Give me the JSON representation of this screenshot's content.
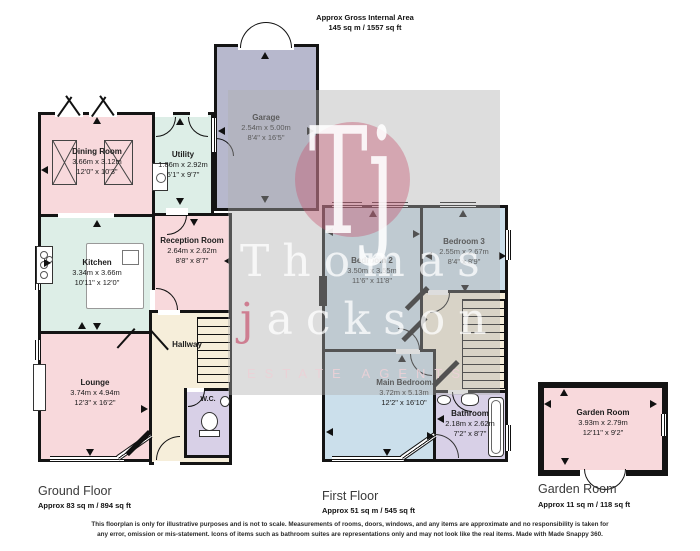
{
  "header": {
    "title": "Approx Gross Internal Area",
    "area": "145 sq m / 1557 sq ft"
  },
  "watermark": {
    "monogram": "Tj",
    "brand_first": "Thomas",
    "brand_second_initial": "j",
    "brand_second_rest": "ackson",
    "tagline": "ESTATE AGENTS"
  },
  "rooms": {
    "dining": {
      "name": "Dining Room",
      "metric": "3.66m x 3.12m",
      "imperial": "12'0\" x 10'3\""
    },
    "utility": {
      "name": "Utility",
      "metric": "1.86m x 2.92m",
      "imperial": "6'1\" x 9'7\""
    },
    "garage": {
      "name": "Garage",
      "metric": "2.54m x 5.00m",
      "imperial": "8'4\" x 16'5\""
    },
    "kitchen": {
      "name": "Kitchen",
      "metric": "3.34m x 3.66m",
      "imperial": "10'11\" x 12'0\""
    },
    "reception": {
      "name": "Reception Room",
      "metric": "2.64m x 2.62m",
      "imperial": "8'8\" x 8'7\""
    },
    "lounge": {
      "name": "Lounge",
      "metric": "3.74m x 4.94m",
      "imperial": "12'3\" x 16'2\""
    },
    "hallway": {
      "name": "Hallway"
    },
    "wc": {
      "name": "W.C."
    },
    "bedroom2": {
      "name": "Bedroom 2",
      "metric": "3.50m x 3.55m",
      "imperial": "11'6\" x 11'8\""
    },
    "bedroom3": {
      "name": "Bedroom 3",
      "metric": "2.55m x 2.67m",
      "imperial": "8'4\" x 8'9\""
    },
    "main_bedroom": {
      "name": "Main Bedroom",
      "metric": "3.72m x 5.13m",
      "imperial": "12'2\" x 16'10\""
    },
    "bathroom": {
      "name": "Bathroom",
      "metric": "2.18m x 2.62m",
      "imperial": "7'2\" x 8'7\""
    },
    "garden_room": {
      "name": "Garden Room",
      "metric": "3.93m x 2.79m",
      "imperial": "12'11\" x 9'2\""
    }
  },
  "floors": {
    "ground": {
      "label": "Ground Floor",
      "area": "Approx 83 sq m / 894 sq ft"
    },
    "first": {
      "label": "First Floor",
      "area": "Approx 51 sq m / 545 sq ft"
    },
    "garden": {
      "label": "Garden Room",
      "area": "Approx 11 sq m / 118 sq ft"
    }
  },
  "footer": {
    "disclaimer": "This floorplan is only for illustrative purposes and is not to scale. Measurements of rooms, doors, windows, and any items are approximate and no responsibility is taken for any error, omission or mis-statement. Icons of items such as bathroom suites are representations only and may not look like the real items. Made with Made Snappy 360."
  },
  "colors": {
    "wall": "#141414",
    "pink": "#f8d9dc",
    "mint": "#ddeee7",
    "purple": "#b7b8cd",
    "blue": "#cbdfeb",
    "lavender": "#d8d0e7",
    "cream": "#f6eeda",
    "watermark_grey": "rgba(175,175,175,0.42)",
    "brand_pink": "rgba(199,86,112,0.4)"
  }
}
